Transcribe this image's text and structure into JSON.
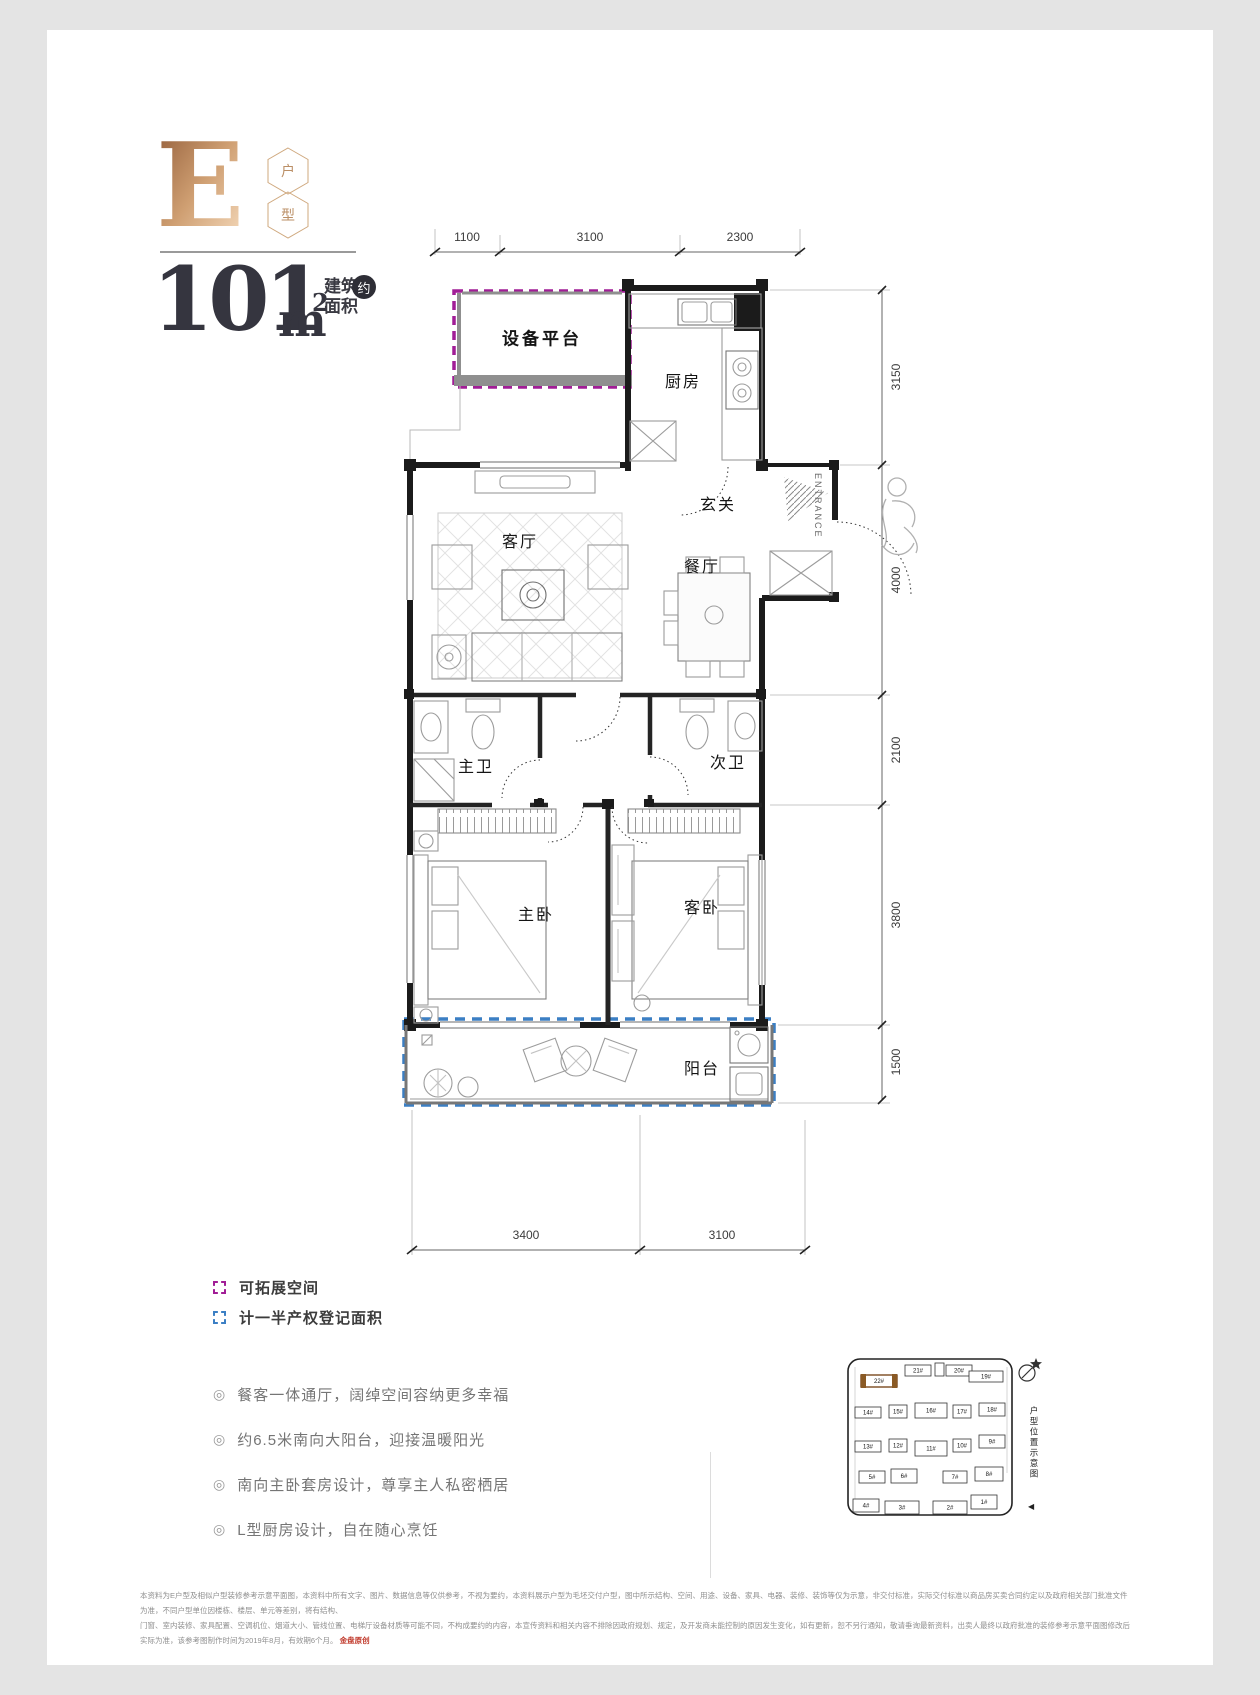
{
  "header": {
    "type_letter": "E",
    "badge_top": "户",
    "badge_bottom": "型",
    "area_value": "101",
    "area_unit": "m",
    "area_exp": "2",
    "area_label": "建筑\n面积",
    "area_approx": "约"
  },
  "plan": {
    "rooms": {
      "equipment": "设备平台",
      "kitchen": "厨房",
      "foyer": "玄关",
      "living": "客厅",
      "dining": "餐厅",
      "master_bath": "主卫",
      "second_bath": "次卫",
      "master_bed": "主卧",
      "guest_bed": "客卧",
      "balcony": "阳台"
    },
    "entrance": "ENTRANCE",
    "dims": {
      "top": [
        "1100",
        "3100",
        "2300"
      ],
      "right": [
        "3150",
        "4000",
        "2100",
        "3800",
        "1500"
      ],
      "bottom": [
        "3400",
        "3100"
      ]
    },
    "colors": {
      "expandable_dashed": "#a11d96",
      "half_area_dashed": "#3b7fc4"
    }
  },
  "legend": {
    "items": [
      {
        "label": "可拓展空间",
        "color": "#a11d96"
      },
      {
        "label": "计一半产权登记面积",
        "color": "#3b7fc4"
      }
    ]
  },
  "features": {
    "icon": "◎",
    "items": [
      "餐客一体通厅，阔绰空间容纳更多幸福",
      "约6.5米南向大阳台，迎接温暖阳光",
      "南向主卧套房设计，尊享主人私密栖居",
      "L型厨房设计，自在随心烹饪"
    ]
  },
  "siteplan": {
    "caption": "户型位置示意图",
    "pointer": "◀",
    "highlight": "22#",
    "buildings": [
      {
        "label": "22#",
        "x": 16,
        "y": 22,
        "w": 36,
        "h": 12,
        "hl": true
      },
      {
        "label": "21#",
        "x": 60,
        "y": 12,
        "w": 26,
        "h": 11
      },
      {
        "label": "",
        "x": 90,
        "y": 10,
        "w": 9,
        "h": 13
      },
      {
        "label": "20#",
        "x": 101,
        "y": 12,
        "w": 26,
        "h": 11
      },
      {
        "label": "19#",
        "x": 124,
        "y": 18,
        "w": 34,
        "h": 11
      },
      {
        "label": "14#",
        "x": 10,
        "y": 54,
        "w": 26,
        "h": 11
      },
      {
        "label": "15#",
        "x": 44,
        "y": 52,
        "w": 18,
        "h": 13
      },
      {
        "label": "16#",
        "x": 70,
        "y": 50,
        "w": 32,
        "h": 15
      },
      {
        "label": "17#",
        "x": 108,
        "y": 52,
        "w": 18,
        "h": 13
      },
      {
        "label": "18#",
        "x": 134,
        "y": 50,
        "w": 26,
        "h": 13
      },
      {
        "label": "13#",
        "x": 10,
        "y": 88,
        "w": 26,
        "h": 11
      },
      {
        "label": "12#",
        "x": 44,
        "y": 86,
        "w": 18,
        "h": 13
      },
      {
        "label": "11#",
        "x": 70,
        "y": 88,
        "w": 32,
        "h": 15
      },
      {
        "label": "10#",
        "x": 108,
        "y": 86,
        "w": 18,
        "h": 13
      },
      {
        "label": "9#",
        "x": 134,
        "y": 82,
        "w": 26,
        "h": 13
      },
      {
        "label": "5#",
        "x": 14,
        "y": 118,
        "w": 26,
        "h": 12
      },
      {
        "label": "6#",
        "x": 46,
        "y": 116,
        "w": 26,
        "h": 14
      },
      {
        "label": "7#",
        "x": 98,
        "y": 118,
        "w": 24,
        "h": 12
      },
      {
        "label": "8#",
        "x": 130,
        "y": 114,
        "w": 28,
        "h": 14
      },
      {
        "label": "4#",
        "x": 8,
        "y": 146,
        "w": 26,
        "h": 13
      },
      {
        "label": "3#",
        "x": 40,
        "y": 148,
        "w": 34,
        "h": 13
      },
      {
        "label": "2#",
        "x": 88,
        "y": 148,
        "w": 34,
        "h": 13
      },
      {
        "label": "1#",
        "x": 126,
        "y": 142,
        "w": 26,
        "h": 14
      }
    ]
  },
  "footer": {
    "line1": "本资料为E户型及相似户型装修参考示意平面图，本资料中所有文字、图片、数据信息等仅供参考，不视为要约，本资料展示户型为毛坯交付户型，图中所示结构、空间、用途、设备、家具、电器、装修、装饰等仅为示意，非交付标准，实际交付标准以商品房买卖合同约定以及政府相关部门批准文件为准，不同户型单位因楼栋、楼层、单元等差别，将有结构、",
    "line2": "门窗、室内装修、家具配置、空调机位、烟道大小、管线位置、电梯厅设备材质等可能不同，不构成要约的内容，本宣传资料和相关内容不排除因政府规划、规定，及开发商未能控制的原因发生变化，如有更新，恕不另行通知，敬请垂询最新资料，出卖人最终以政府批准的装修参考示意平面图修改后实际为准，该参考图制作时间为2019年8月，有效期6个月。",
    "brand": "金盘原创"
  }
}
